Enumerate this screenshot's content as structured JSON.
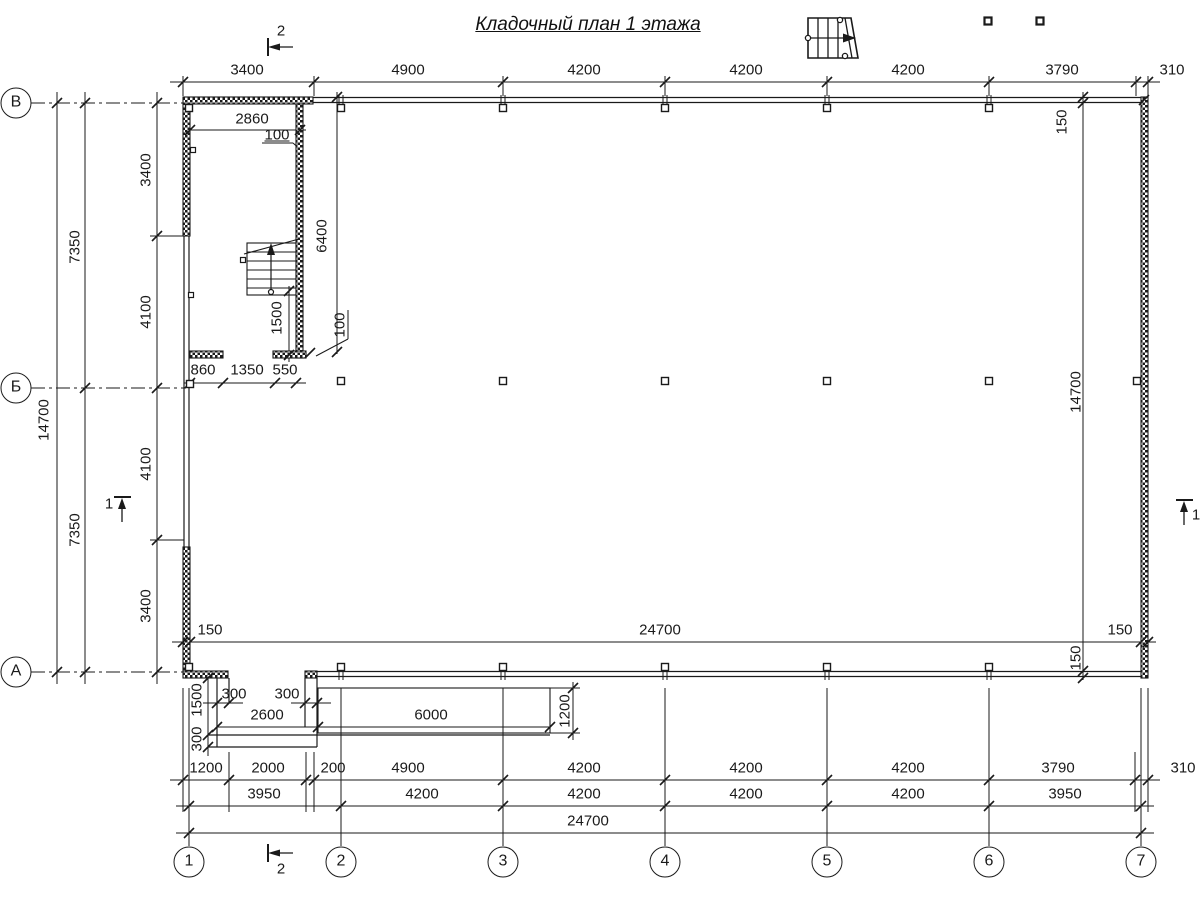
{
  "title": "Кладочный план 1 этажа",
  "colors": {
    "line": "#1a1a1a",
    "background": "#ffffff"
  },
  "grid": {
    "bubble_y": 862,
    "bubble_x": 16,
    "columns": [
      {
        "label": "1",
        "x": 189
      },
      {
        "label": "2",
        "x": 341
      },
      {
        "label": "3",
        "x": 503
      },
      {
        "label": "4",
        "x": 665
      },
      {
        "label": "5",
        "x": 827
      },
      {
        "label": "6",
        "x": 989
      },
      {
        "label": "7",
        "x": 1141
      }
    ],
    "rows": [
      {
        "label": "В",
        "y": 103
      },
      {
        "label": "Б",
        "y": 388
      },
      {
        "label": "А",
        "y": 672
      }
    ]
  },
  "dimension_chains": {
    "top": [
      "3400",
      "4900",
      "4200",
      "4200",
      "4200",
      "3790",
      "310"
    ],
    "inner_bottom": [
      "150",
      "24700",
      "150"
    ],
    "bottom_row_1": [
      "1200",
      "2000",
      "200",
      "4900",
      "4200",
      "4200",
      "4200",
      "3790",
      "310"
    ],
    "bottom_row_2": [
      "3950",
      "4200",
      "4200",
      "4200",
      "4200",
      "3950"
    ],
    "bottom_total": "24700",
    "left_inner": [
      "3400",
      "4100",
      "4100",
      "3400"
    ],
    "left_middle": [
      "7350",
      "7350"
    ],
    "left_total": "14700",
    "right": [
      "150",
      "14700",
      "150"
    ],
    "stair_area": [
      "2860",
      "100",
      "6400",
      "1500",
      "100",
      "860",
      "1350",
      "550"
    ],
    "porch": [
      "300",
      "300",
      "2600",
      "6000",
      "1500",
      "300",
      "1200"
    ]
  },
  "section_markers": [
    "1",
    "2"
  ],
  "annotations": [
    {
      "t": "3400",
      "x": 247,
      "y": 70
    },
    {
      "t": "4900",
      "x": 408,
      "y": 70
    },
    {
      "t": "4200",
      "x": 584,
      "y": 70
    },
    {
      "t": "4200",
      "x": 746,
      "y": 70
    },
    {
      "t": "4200",
      "x": 908,
      "y": 70
    },
    {
      "t": "3790",
      "x": 1062,
      "y": 70
    },
    {
      "t": "310",
      "x": 1172,
      "y": 70
    },
    {
      "t": "2860",
      "x": 252,
      "y": 119
    },
    {
      "t": "100",
      "x": 277,
      "y": 135,
      "u": true
    },
    {
      "t": "6400",
      "x": 322,
      "y": 236,
      "r": -90
    },
    {
      "t": "1500",
      "x": 277,
      "y": 318,
      "r": -90
    },
    {
      "t": "100",
      "x": 340,
      "y": 325,
      "r": -90
    },
    {
      "t": "860",
      "x": 203,
      "y": 370
    },
    {
      "t": "1350",
      "x": 247,
      "y": 370
    },
    {
      "t": "550",
      "x": 285,
      "y": 370
    },
    {
      "t": "3400",
      "x": 146,
      "y": 170,
      "r": -90
    },
    {
      "t": "4100",
      "x": 146,
      "y": 312,
      "r": -90
    },
    {
      "t": "4100",
      "x": 146,
      "y": 464,
      "r": -90
    },
    {
      "t": "3400",
      "x": 146,
      "y": 606,
      "r": -90
    },
    {
      "t": "7350",
      "x": 75,
      "y": 247,
      "r": -90
    },
    {
      "t": "7350",
      "x": 75,
      "y": 530,
      "r": -90
    },
    {
      "t": "14700",
      "x": 44,
      "y": 420,
      "r": -90
    },
    {
      "t": "150",
      "x": 1062,
      "y": 122,
      "r": -90
    },
    {
      "t": "14700",
      "x": 1076,
      "y": 392,
      "r": -90
    },
    {
      "t": "150",
      "x": 1076,
      "y": 658,
      "r": -90
    },
    {
      "t": "150",
      "x": 210,
      "y": 630
    },
    {
      "t": "24700",
      "x": 660,
      "y": 630
    },
    {
      "t": "150",
      "x": 1120,
      "y": 630
    },
    {
      "t": "300",
      "x": 234,
      "y": 694
    },
    {
      "t": "300",
      "x": 287,
      "y": 694
    },
    {
      "t": "2600",
      "x": 267,
      "y": 715
    },
    {
      "t": "6000",
      "x": 431,
      "y": 715
    },
    {
      "t": "1500",
      "x": 197,
      "y": 700,
      "r": -90
    },
    {
      "t": "300",
      "x": 197,
      "y": 739,
      "r": -90
    },
    {
      "t": "1200",
      "x": 565,
      "y": 711,
      "r": -90
    },
    {
      "t": "1200",
      "x": 206,
      "y": 768
    },
    {
      "t": "2000",
      "x": 268,
      "y": 768
    },
    {
      "t": "200",
      "x": 333,
      "y": 768
    },
    {
      "t": "4900",
      "x": 408,
      "y": 768
    },
    {
      "t": "4200",
      "x": 584,
      "y": 768
    },
    {
      "t": "4200",
      "x": 746,
      "y": 768
    },
    {
      "t": "4200",
      "x": 908,
      "y": 768
    },
    {
      "t": "3790",
      "x": 1058,
      "y": 768
    },
    {
      "t": "310",
      "x": 1183,
      "y": 768
    },
    {
      "t": "3950",
      "x": 264,
      "y": 794
    },
    {
      "t": "4200",
      "x": 422,
      "y": 794
    },
    {
      "t": "4200",
      "x": 584,
      "y": 794
    },
    {
      "t": "4200",
      "x": 746,
      "y": 794
    },
    {
      "t": "4200",
      "x": 908,
      "y": 794
    },
    {
      "t": "3950",
      "x": 1065,
      "y": 794
    },
    {
      "t": "24700",
      "x": 588,
      "y": 821
    },
    {
      "t": "2",
      "x": 281,
      "y": 31,
      "name": "section-2-label-top"
    },
    {
      "t": "2",
      "x": 281,
      "y": 869,
      "name": "section-2-label-bottom"
    },
    {
      "t": "1",
      "x": 109,
      "y": 504,
      "name": "section-1-label-left"
    },
    {
      "t": "1",
      "x": 1196,
      "y": 515,
      "name": "section-1-label-right"
    }
  ]
}
